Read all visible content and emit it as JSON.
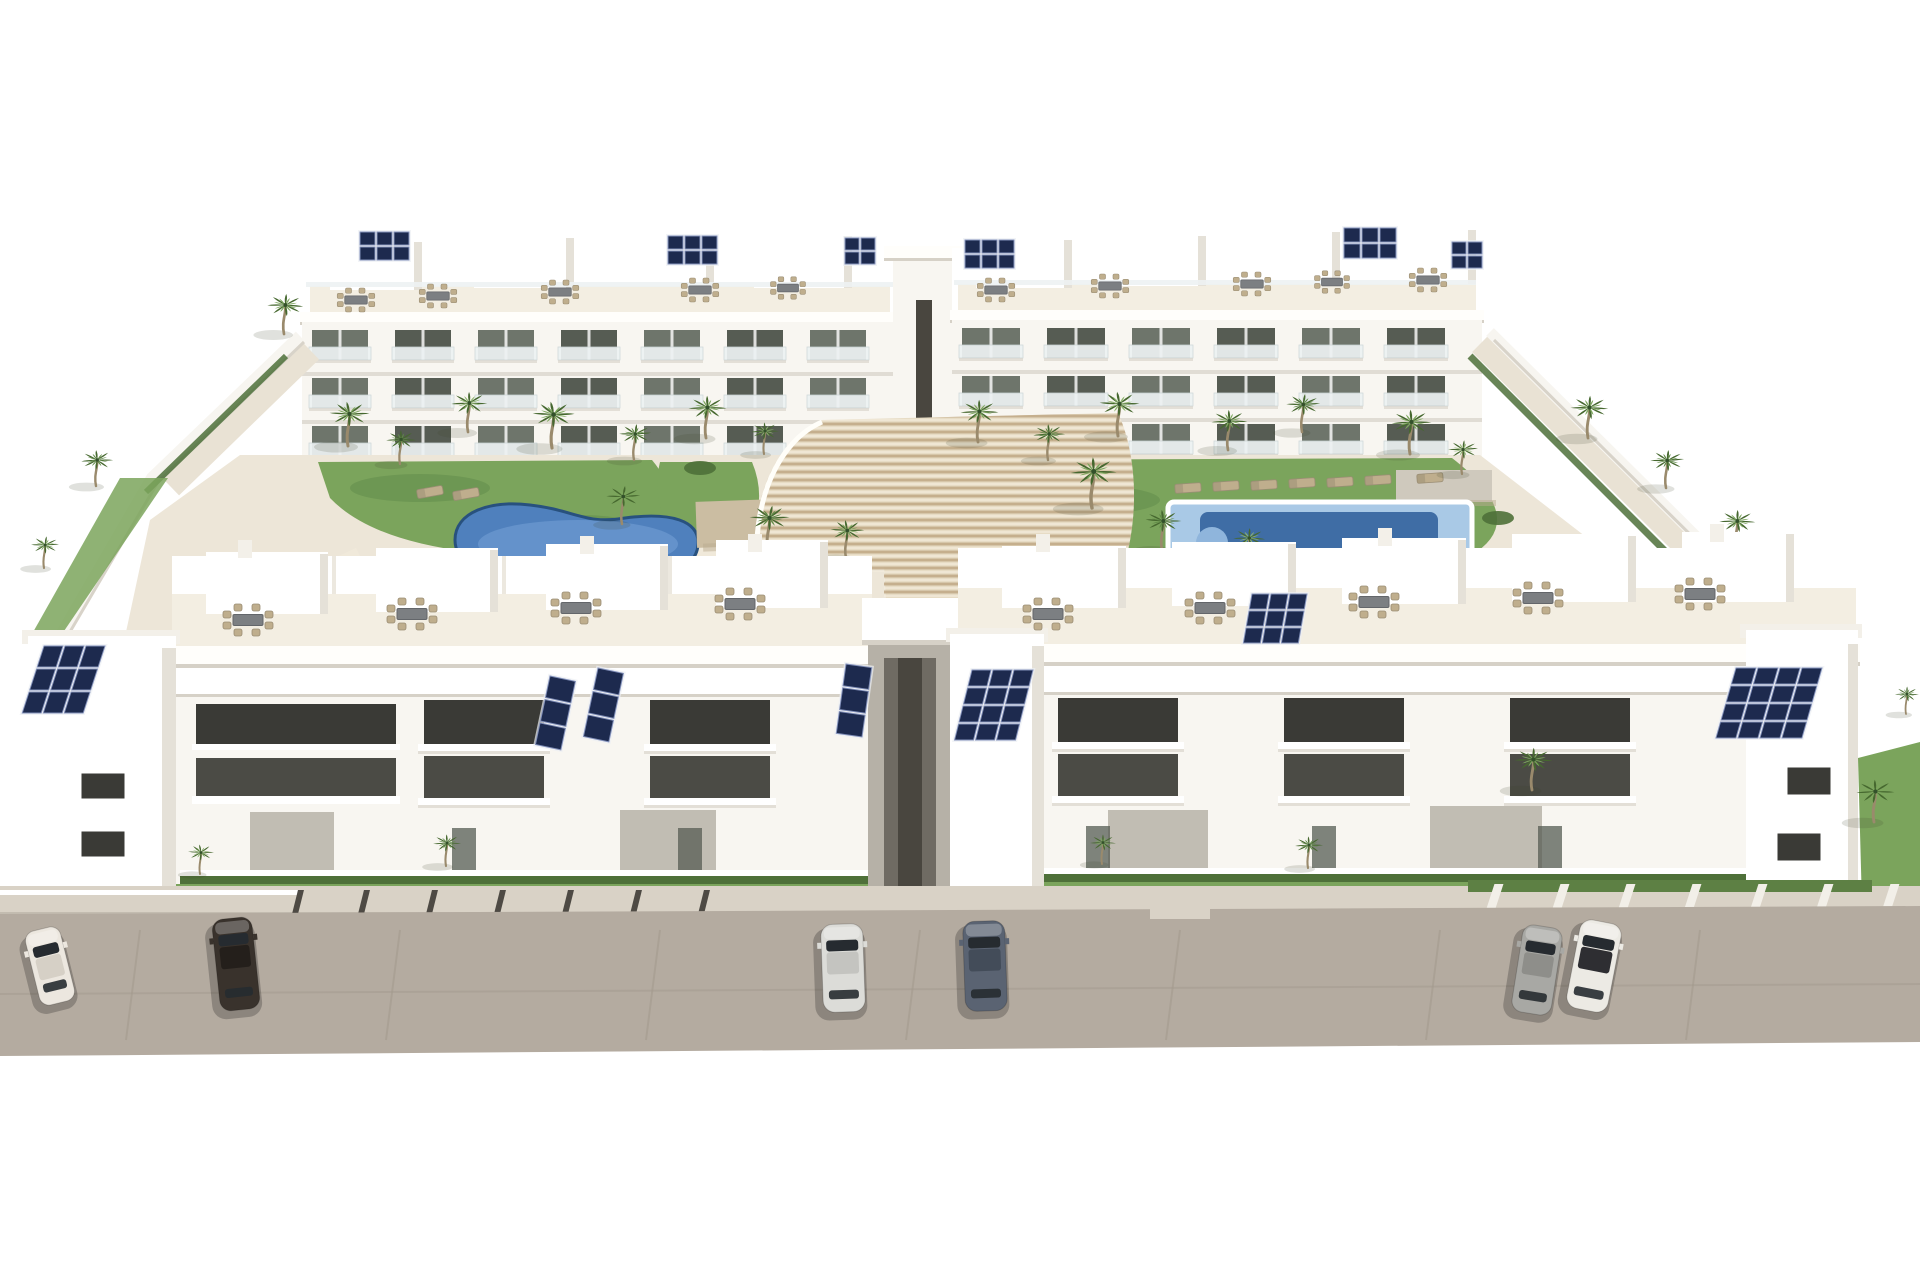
{
  "scene": {
    "type": "3d-architectural-render",
    "title": "Aerial 3D render — white apartment complex with pools and palm courtyard",
    "description": "Aerial daylight rendering of a modern white residential complex: two rows of three-storey apartment blocks with glass balconies, rooftop terraces with outdoor dining sets and dark-blue solar panel arrays, arranged around a landscaped courtyard containing a freeform swimming pool on the left, a rectangular swimming pool with sun loungers on the right, many palm trees, lawns and a fan of curved timber deck steps in the center. A tan street runs along the front with six parked cars.",
    "background": "#ffffff"
  },
  "palette": {
    "bg": "#ffffff",
    "white": "#ffffff",
    "facade": "#f8f6f1",
    "facadeShade": "#ece8df",
    "parapet": "#fffefb",
    "slabShadow": "#d6d1c7",
    "sideShade": "#e5e1d8",
    "roofSlab": "#f3f0e9",
    "terraceFloor": "#f3eee2",
    "rail": "#edf2f3",
    "railLine": "#ccd6d8",
    "glass": "#6e756b",
    "glassDark": "#565c53",
    "winTop": "#3a3a36",
    "winMid": "#4b4b45",
    "courtyard": "#ede6d8",
    "pathLight": "#f0e9da",
    "lawn": "#7ba45c",
    "lawnDark": "#5f8a49",
    "hedge": "#4e7039",
    "hedgeLight": "#5d8044",
    "frond0": "#46682f",
    "frond1": "#5f8a46",
    "frond2": "#7ca75d",
    "frondTop": "#8fb56f",
    "trunk": "#9a8a6c",
    "poolLeft": "#4f80bd",
    "poolLeftLight": "#7fa9dc",
    "poolRim": "#28517e",
    "poolRightOuter": "#a9c9e6",
    "poolRightInner": "#3f6da5",
    "poolStep": "#8fb5dc",
    "wood": "#e7dcc5",
    "woodLine": "#bda480",
    "woodShade": "#c6b391",
    "pergola": "#cbbda2",
    "pergolaGray": "#cfc9bd",
    "furniture": "#bfae8d",
    "furnitureDark": "#9a8d74",
    "table": "#7c7f82",
    "panelGray": "#c1bdb3",
    "corridor": "#b6b1a7",
    "corridorDark": "#6f6b63",
    "corridorSlot": "#49463f",
    "sidewalk": "#d9d2c6",
    "curb": "#c3bcb0",
    "postDark": "#4e4a44",
    "postLight": "#f2efe8",
    "street": "#b4aba0",
    "streetSeam": "#a49b8f",
    "solar": "#1d2a4e",
    "solarLine": "#8391bb",
    "carShadow": "rgba(0,0,0,0.22)"
  },
  "counts": {
    "building_blocks": 4,
    "storeys": 3,
    "swimming_pools": 2,
    "parked_cars": 6,
    "palm_trees": 34,
    "solar_panel_arrays": 13,
    "rooftop_dining_sets": 19,
    "sun_loungers": 9
  },
  "palms_courtyard": [
    [
      348,
      444,
      1.0,
      1
    ],
    [
      400,
      462,
      0.75,
      0
    ],
    [
      468,
      430,
      0.9,
      2
    ],
    [
      552,
      446,
      1.05,
      1
    ],
    [
      634,
      458,
      0.8,
      0
    ],
    [
      706,
      436,
      0.95,
      1
    ],
    [
      764,
      452,
      0.7,
      2
    ],
    [
      978,
      440,
      0.95,
      1
    ],
    [
      1048,
      458,
      0.8,
      0
    ],
    [
      1118,
      434,
      1.0,
      2
    ],
    [
      1228,
      448,
      0.9,
      1
    ],
    [
      1302,
      430,
      0.85,
      0
    ],
    [
      1410,
      452,
      1.0,
      1
    ],
    [
      1462,
      472,
      0.75,
      2
    ],
    [
      622,
      522,
      0.85,
      1
    ],
    [
      768,
      548,
      1.0,
      0
    ],
    [
      846,
      556,
      0.85,
      1
    ],
    [
      1092,
      506,
      1.15,
      1
    ],
    [
      1162,
      548,
      0.9,
      0
    ],
    [
      1248,
      562,
      0.8,
      2
    ],
    [
      1588,
      436,
      0.95,
      1
    ],
    [
      1666,
      486,
      0.85,
      0
    ],
    [
      1736,
      548,
      0.9,
      1
    ],
    [
      1788,
      596,
      0.75,
      2
    ],
    [
      284,
      332,
      0.9,
      1
    ],
    [
      96,
      484,
      0.8,
      0
    ],
    [
      44,
      566,
      0.7,
      1
    ]
  ],
  "palms_front": [
    [
      200,
      872,
      0.65,
      1
    ],
    [
      446,
      864,
      0.7,
      0
    ],
    [
      1102,
      862,
      0.65,
      1
    ],
    [
      1308,
      866,
      0.7,
      0
    ],
    [
      1532,
      788,
      0.95,
      1
    ],
    [
      1874,
      820,
      0.95,
      1
    ],
    [
      1906,
      712,
      0.6,
      0
    ]
  ],
  "cars": [
    {
      "x": 50,
      "y": 966,
      "rot": -14,
      "len": 76,
      "wid": 36,
      "body": "#ece7df",
      "roof": "#d6d0c6"
    },
    {
      "x": 236,
      "y": 964,
      "rot": -6,
      "len": 92,
      "wid": 40,
      "body": "#39322c",
      "roof": "#241f1b"
    },
    {
      "x": 843,
      "y": 968,
      "rot": -2,
      "len": 88,
      "wid": 42,
      "body": "#dcdcd8",
      "roof": "#c4c4c0"
    },
    {
      "x": 985,
      "y": 966,
      "rot": -2,
      "len": 90,
      "wid": 42,
      "body": "#5a6372",
      "roof": "#434c59"
    },
    {
      "x": 1537,
      "y": 970,
      "rot": 9,
      "len": 88,
      "wid": 40,
      "body": "#a8a8a4",
      "roof": "#8e8e8a"
    },
    {
      "x": 1594,
      "y": 966,
      "rot": 11,
      "len": 90,
      "wid": 42,
      "body": "#eceae4",
      "roof": "#2e2e32"
    }
  ],
  "solar_arrays": [
    {
      "x": 360,
      "y": 232,
      "cols": 3,
      "rows": 2,
      "cw": 15,
      "ch": 13
    },
    {
      "x": 668,
      "y": 236,
      "cols": 3,
      "rows": 2,
      "cw": 15,
      "ch": 13
    },
    {
      "x": 845,
      "y": 238,
      "cols": 2,
      "rows": 2,
      "cw": 14,
      "ch": 12
    },
    {
      "x": 965,
      "y": 240,
      "cols": 3,
      "rows": 2,
      "cw": 15,
      "ch": 13
    },
    {
      "x": 1344,
      "y": 228,
      "cols": 3,
      "rows": 2,
      "cw": 16,
      "ch": 14
    },
    {
      "x": 1452,
      "y": 242,
      "cols": 2,
      "rows": 2,
      "cw": 14,
      "ch": 12
    },
    {
      "x": 44,
      "y": 646,
      "cols": 3,
      "rows": 3,
      "cw": 19,
      "ch": 21,
      "skew": -18
    },
    {
      "x": 550,
      "y": 676,
      "cols": 1,
      "rows": 3,
      "cw": 26,
      "ch": 22,
      "rot": 12
    },
    {
      "x": 598,
      "y": 668,
      "cols": 1,
      "rows": 3,
      "cw": 26,
      "ch": 22,
      "rot": 12
    },
    {
      "x": 846,
      "y": 664,
      "cols": 1,
      "rows": 3,
      "cw": 26,
      "ch": 22,
      "rot": 8
    },
    {
      "x": 972,
      "y": 670,
      "cols": 3,
      "rows": 4,
      "cw": 19,
      "ch": 16,
      "skew": -14
    },
    {
      "x": 1252,
      "y": 594,
      "cols": 3,
      "rows": 3,
      "cw": 17,
      "ch": 15,
      "skew": -10
    },
    {
      "x": 1736,
      "y": 668,
      "cols": 4,
      "rows": 4,
      "cw": 20,
      "ch": 16,
      "skew": -16
    }
  ],
  "dining_back": [
    [
      356,
      300,
      0.75
    ],
    [
      438,
      296,
      0.75
    ],
    [
      560,
      292,
      0.75
    ],
    [
      700,
      290,
      0.75
    ],
    [
      788,
      288,
      0.7
    ],
    [
      996,
      290,
      0.75
    ],
    [
      1110,
      286,
      0.75
    ],
    [
      1252,
      284,
      0.75
    ],
    [
      1332,
      282,
      0.7
    ],
    [
      1428,
      280,
      0.75
    ]
  ],
  "dining_front": [
    [
      248,
      620,
      1
    ],
    [
      412,
      614,
      1
    ],
    [
      576,
      608,
      1
    ],
    [
      740,
      604,
      1
    ],
    [
      1048,
      614,
      1
    ],
    [
      1210,
      608,
      1
    ],
    [
      1374,
      602,
      1
    ],
    [
      1538,
      598,
      1
    ],
    [
      1700,
      594,
      1
    ]
  ],
  "loungers": [
    [
      1188,
      488,
      -4
    ],
    [
      1226,
      486,
      -4
    ],
    [
      1264,
      485,
      -4
    ],
    [
      1302,
      483,
      -4
    ],
    [
      1340,
      482,
      -4
    ],
    [
      1378,
      480,
      -4
    ],
    [
      1430,
      478,
      -4
    ],
    [
      430,
      492,
      -10
    ],
    [
      466,
      494,
      -10
    ]
  ],
  "back_window_rows": [
    {
      "x0": 312,
      "y": 330,
      "n": 7,
      "dx": 83,
      "w": 56,
      "h": 30
    },
    {
      "x0": 312,
      "y": 378,
      "n": 7,
      "dx": 83,
      "w": 56,
      "h": 30
    },
    {
      "x0": 312,
      "y": 426,
      "n": 7,
      "dx": 83,
      "w": 56,
      "h": 30
    },
    {
      "x0": 962,
      "y": 328,
      "n": 6,
      "dx": 85,
      "w": 58,
      "h": 30
    },
    {
      "x0": 962,
      "y": 376,
      "n": 6,
      "dx": 85,
      "w": 58,
      "h": 30
    },
    {
      "x0": 962,
      "y": 424,
      "n": 6,
      "dx": 85,
      "w": 58,
      "h": 30
    }
  ],
  "front_window_rows": [
    {
      "x0": 424,
      "y": 700,
      "n": 2,
      "dx": 226,
      "w": 120,
      "h": 44,
      "tone": "top"
    },
    {
      "x0": 424,
      "y": 756,
      "n": 2,
      "dx": 226,
      "w": 120,
      "h": 42,
      "tone": "mid"
    },
    {
      "x0": 1058,
      "y": 698,
      "n": 3,
      "dx": 226,
      "w": 120,
      "h": 44,
      "tone": "top"
    },
    {
      "x0": 1058,
      "y": 754,
      "n": 3,
      "dx": 226,
      "w": 120,
      "h": 42,
      "tone": "mid"
    }
  ],
  "fence_posts": {
    "dark": {
      "xs": [
        292,
        358,
        426,
        494,
        562,
        630,
        698
      ],
      "y": 890,
      "w": 6,
      "h": 24,
      "skew": -14
    },
    "light": {
      "xs": [
        1486,
        1552,
        1618,
        1684,
        1750,
        1816,
        1882
      ],
      "y": 884,
      "w": 9,
      "h": 26,
      "skew": -18
    }
  },
  "street": {
    "seam_xs": [
      140,
      400,
      660,
      920,
      1180,
      1440,
      1700
    ],
    "seam_top": 930,
    "seam_bottom": 1040,
    "cross_seam_y": 990,
    "driveway": {
      "x": 1150,
      "y": 906,
      "w": 60,
      "h": 13
    }
  }
}
